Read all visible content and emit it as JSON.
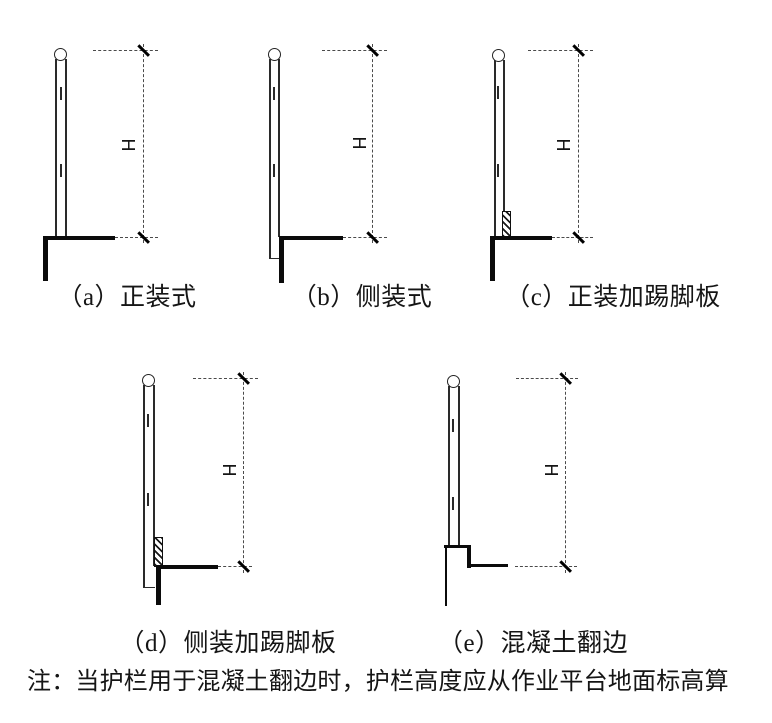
{
  "figure": {
    "diagrams": [
      {
        "key": "a",
        "caption": "（a）正装式",
        "dim_label": "H"
      },
      {
        "key": "b",
        "caption": "（b）侧装式",
        "dim_label": "H"
      },
      {
        "key": "c",
        "caption": "（c）正装加踢脚板",
        "dim_label": "H"
      },
      {
        "key": "d",
        "caption": "（d）侧装加踢脚板",
        "dim_label": "H"
      },
      {
        "key": "e",
        "caption": "（e）混凝土翻边",
        "dim_label": "H"
      }
    ],
    "note": "注：当护栏用于混凝土翻边时，护栏高度应从作业平台地面标高算",
    "colors": {
      "ink": "#151515",
      "line": "#0b0b0b",
      "background": "#ffffff"
    }
  }
}
